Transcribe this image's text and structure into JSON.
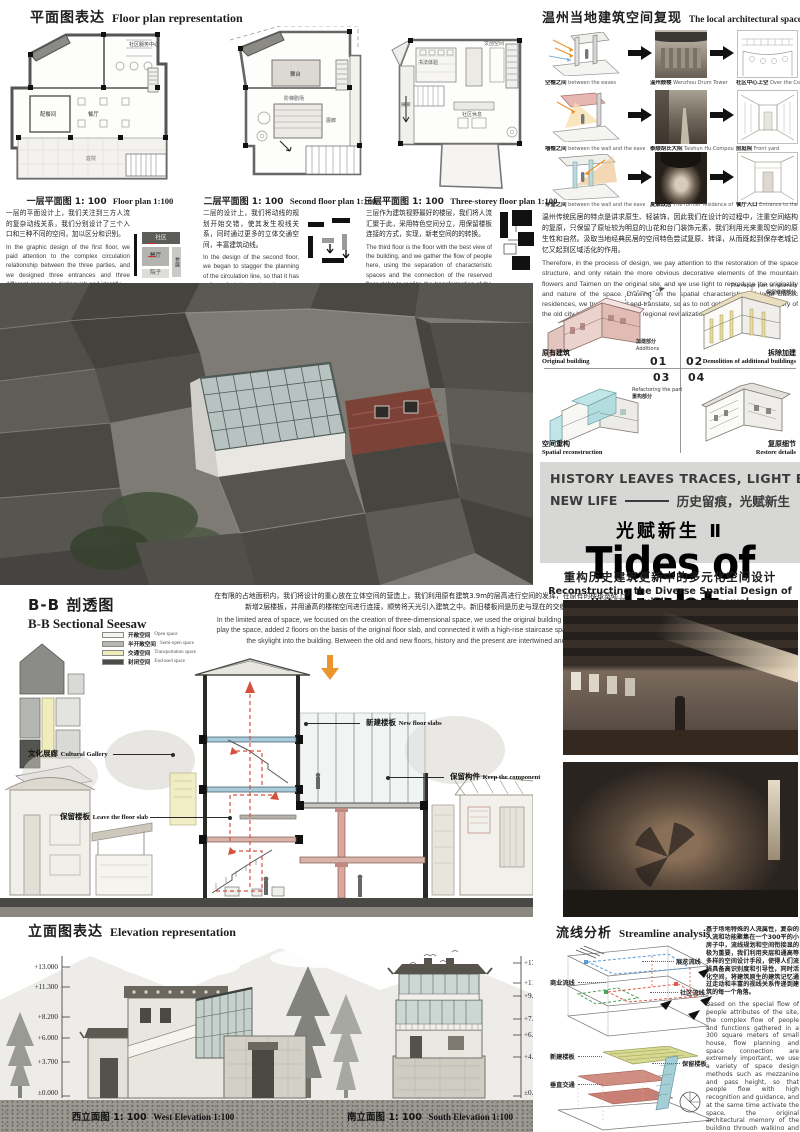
{
  "plans": {
    "header_zh": "平面图表达",
    "header_en": "Floor plan representation",
    "items": [
      {
        "zh": "一层平面图",
        "scale": "1: 100",
        "en": "Floor plan 1:100",
        "desc_zh": "一层的平面设计上，我们关注到三方人流的复杂动线关系，我们分别设计了三个入口和三种不同的空间，加以区分和识别。",
        "desc_en": "In the graphic design of the first floor, we paid attention to the complex circulation relationship between the three parties, and we designed three entrances and three different spaces to distinguish and identify.",
        "rooms": [
          "社区服务中心",
          "配餐间",
          "餐厅",
          "庭院"
        ],
        "diagram": [
          "社区",
          "餐厅",
          "参展",
          "院子"
        ]
      },
      {
        "zh": "二层平面图",
        "scale": "1: 100",
        "en": "Second floor plan 1:100",
        "desc_zh": "二层的设计上，我们将动线的规划开始交错，使其发生视线关系，同时通过更多的立体交通空间，丰富建筑动线。",
        "desc_en": "In the design of the second floor, we began to stagger the planning of the circulation line, so that it has a line of sight, and at the same time, through more three-dimensional traffic space, the building circulation line is enriched.",
        "rooms": [
          "舞台",
          "阶梯剧场",
          "展廊"
        ]
      },
      {
        "zh": "三层平面图",
        "scale": "1: 100",
        "en": "Three-storey floor plan 1:100",
        "desc_zh": "三层作为建筑视野最好的楼层，我们将人流汇聚于此，采用特色空间分立，用保留楼板连接的方式，实现，新老空间的的转换。",
        "desc_en": "The third floor is the floor with the best view of the building, and we gather the flow of people here, using the separation of characteristic spaces and the connection of the reserved floor slabs to realize the transformation of the old and new spaces.",
        "rooms": [
          "书法体验",
          "文创空间",
          "社区休息",
          "展廊"
        ]
      }
    ]
  },
  "wenzhou": {
    "header_zh": "温州当地建筑空间复现",
    "header_en": "The local architectural space of Wenzhou is reproduced",
    "rows": [
      {
        "l_zh": "空檐之间",
        "l_en": "between the eaves",
        "m_zh": "温州鼓楼",
        "m_en": "Wenzhou Drum Tower",
        "r_zh": "社区中心上空",
        "r_en": "Over the Community Center"
      },
      {
        "l_zh": "墙檐之间",
        "l_en": "between the wall and the eaves",
        "m_zh": "泰顺胡氏大院",
        "m_en": "Taishun Hu Compound",
        "r_zh": "前庭院",
        "r_en": "Front yard"
      },
      {
        "l_zh": "穿堂之间",
        "l_en": "between the wall and the eaves",
        "m_zh": "夏鼐故居",
        "m_en": "The former residence of Xia Nai",
        "r_zh": "餐厅入口",
        "r_en": "Entrance to the restaurant"
      }
    ],
    "desc_zh": "温州传统民居的特点是讲求原生、轻装饰，因此我们在设计的过程中，注重空间结构的复原，只保留了原址较为明显的山花和台门装饰元素，我们利用光来重现空间的原生性和自然。汲取当地经典民居的空间特色尝试复原、转译，从而既起到保存老城记忆又起到区域活化的作用。",
    "desc_en": "Therefore, in the process of design, we pay attention to the restoration of the space structure, and only retain the more obvious decorative elements of the mountain flowers and Taimen on the original site, and we use light to reproduce the originality and nature of the space. Drawing on the spatial characteristics of local classic residences, we try to restore and translate, so as to not only preserve the memory of the old city but also play a role in regional revitalization."
  },
  "steps": {
    "items": [
      {
        "num": "01",
        "zh": "原有建筑",
        "en": "Original building",
        "note_zh": "加建部分",
        "note_en": "Additions"
      },
      {
        "num": "02",
        "zh": "拆除加建",
        "en": "Demolition of additional buildings",
        "note_zh": "保留修缮部分",
        "note_en": "The repair part is retained"
      },
      {
        "num": "03",
        "zh": "空间重构",
        "en": "Spatial reconstruction",
        "note_zh": "重构部分",
        "note_en": "Refactoring the part"
      },
      {
        "num": "04",
        "zh": "复原细节",
        "en": "Restore details"
      }
    ]
  },
  "title": {
    "l1": "HISTORY LEAVES TRACES,  LIGHT ENDOWS",
    "l2a": "NEW LIFE",
    "l2b": "历史留痕，光赋新生",
    "series": "光赋新生 Ⅱ",
    "main": "Tides of light",
    "sub_zh": "重构历史建筑更新中的多元化空间设计",
    "sub_en": "Reconstructing the Diverse Spatial Design of Historic Buildings in Renewal"
  },
  "bb": {
    "header_zh": "B-B 剖透图",
    "header_en": "B-B Sectional Seesaw",
    "legend": [
      {
        "zh": "开敞空间",
        "en": "Open space",
        "color": "#f4f4f1"
      },
      {
        "zh": "半开敞空间",
        "en": "Semi-open space",
        "color": "#b6b6b2"
      },
      {
        "zh": "交通空间",
        "en": "Transportation space",
        "color": "#f1ecbb"
      },
      {
        "zh": "封闭空间",
        "en": "Enclosed space",
        "color": "#4b4b47"
      }
    ],
    "desc_zh": "在有限的占地面积内，我们将设计的重心放在立体空间的营造上，我们利用原有建筑3.9m的层高进行空间的发挥，在原有的楼板基础上新增2层楼板，并用通高的楼梯空间进行连接，顺势将天光引入建筑之中。新旧楼板间是历史与现在的交织和碰撞。",
    "desc_en": "In the limited area of space, we focused on the creation of three-dimensional space, we used the original building 3.9m floor height to play the space, added 2 floors on the basis of the original floor slab, and connected it with a high-rise staircase space, and introduced the skylight into the building. Between the old and new floors, history and the present are intertwined and collided.",
    "labels": [
      {
        "zh": "文化展廊",
        "en": "Cultural Gallery"
      },
      {
        "zh": "保留楼板",
        "en": "Leave the floor slab"
      },
      {
        "zh": "新建楼板",
        "en": "New floor slabs"
      },
      {
        "zh": "保留构件",
        "en": "Keep the component"
      }
    ]
  },
  "elev": {
    "header_zh": "立面图表达",
    "header_en": "Elevation representation",
    "west": {
      "zh": "西立面图",
      "scale": "1: 100",
      "en": "West Elevation 1:100",
      "levels": [
        "+13.000",
        "+11.300",
        "+8.200",
        "+6.000",
        "+3.700",
        "±0.000"
      ]
    },
    "south": {
      "zh": "南立面图",
      "scale": "1: 100",
      "en": "South Elevation 1:100",
      "levels": [
        "+13.000",
        "+11.560",
        "+9.400",
        "+7.200",
        "+6.200",
        "+4.200",
        "±0.000"
      ]
    }
  },
  "stream": {
    "header_zh": "流线分析",
    "header_en": "Streamline analysis",
    "flows": [
      {
        "zh": "展览流线",
        "color": "#5b9bd5"
      },
      {
        "zh": "商业流线",
        "color": "#4ba05b"
      },
      {
        "zh": "社区流线",
        "color": "#e05b4b"
      }
    ],
    "slabs": [
      {
        "zh": "新建楼板"
      },
      {
        "zh": "保留楼板"
      },
      {
        "zh": "垂直交通"
      }
    ],
    "desc_zh": "基于场地特殊的人流属性，复杂的人流和功能聚集在一个300平的小房子中，流线规划和空间衔接显的极为重要，我们利用夹层和通高等多样的空间设计手段，使得人们流线具备高识别度和引导性，同时活化空间，将建筑原生的建筑记忆通过走动和丰富的视线关系传递到建筑的每一个角落。",
    "desc_en": "Based on the special flow of people attributes of the site, the complex flow of people and functions gathered in a 300 square meters of small house, flow planning and space connection are extremely important, we use a variety of space design methods such as mezzanine and pass height, so that people flow with high recognition and guidance, and at the same time activate the space, the original architectural memory of the building through walking and rich line of sight relationship to every corner of the building."
  },
  "colors": {
    "accent_orange": "#e9962e",
    "circulation_red": "#d6503c",
    "new_slab_blue": "#aacbdb",
    "retained_pink": "#d9a79e",
    "reconstruction_cyan": "#bfe4e6",
    "original_pink": "#ecd2cd",
    "title_box_gray": "#d7d7d5"
  }
}
